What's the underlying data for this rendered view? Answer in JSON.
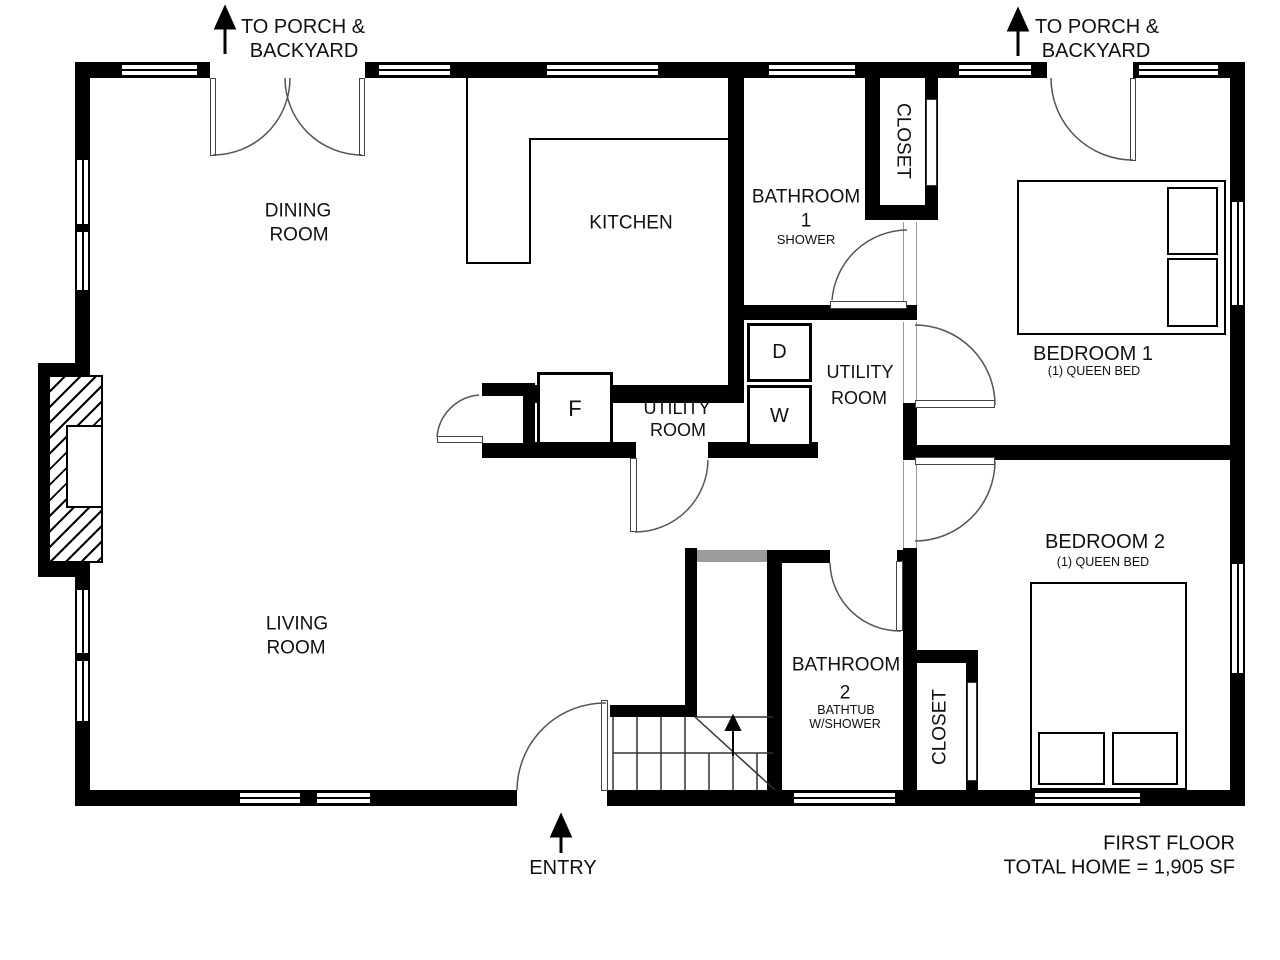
{
  "meta": {
    "floor_label": "FIRST FLOOR",
    "area_label": "TOTAL HOME = 1,905 SF"
  },
  "annotations": {
    "porch_left": [
      "TO PORCH &",
      "BACKYARD"
    ],
    "porch_right": [
      "TO PORCH &",
      "BACKYARD"
    ],
    "entry": "ENTRY"
  },
  "rooms": {
    "dining": [
      "DINING",
      "ROOM"
    ],
    "kitchen": "KITCHEN",
    "living": [
      "LIVING",
      "ROOM"
    ],
    "bathroom1": {
      "title": "BATHROOM",
      "num": "1",
      "note": "SHOWER"
    },
    "bathroom2": {
      "title": "BATHROOM",
      "num": "2",
      "note1": "BATHTUB",
      "note2": "W/SHOWER"
    },
    "utility_hall": [
      "UTILITY",
      "ROOM"
    ],
    "utility_laundry": [
      "UTILITY",
      "ROOM"
    ],
    "bedroom1": {
      "title": "BEDROOM 1",
      "note": "(1) QUEEN BED"
    },
    "bedroom2": {
      "title": "BEDROOM 2",
      "note": "(1) QUEEN BED"
    },
    "closet_upper": "CLOSET",
    "closet_lower": "CLOSET"
  },
  "appliances": {
    "furnace": "F",
    "dryer": "D",
    "washer": "W"
  },
  "colors": {
    "wall": "#000000",
    "landing_half_wall": "#9b9b9b",
    "door_arc": "#555555",
    "background": "#ffffff"
  }
}
